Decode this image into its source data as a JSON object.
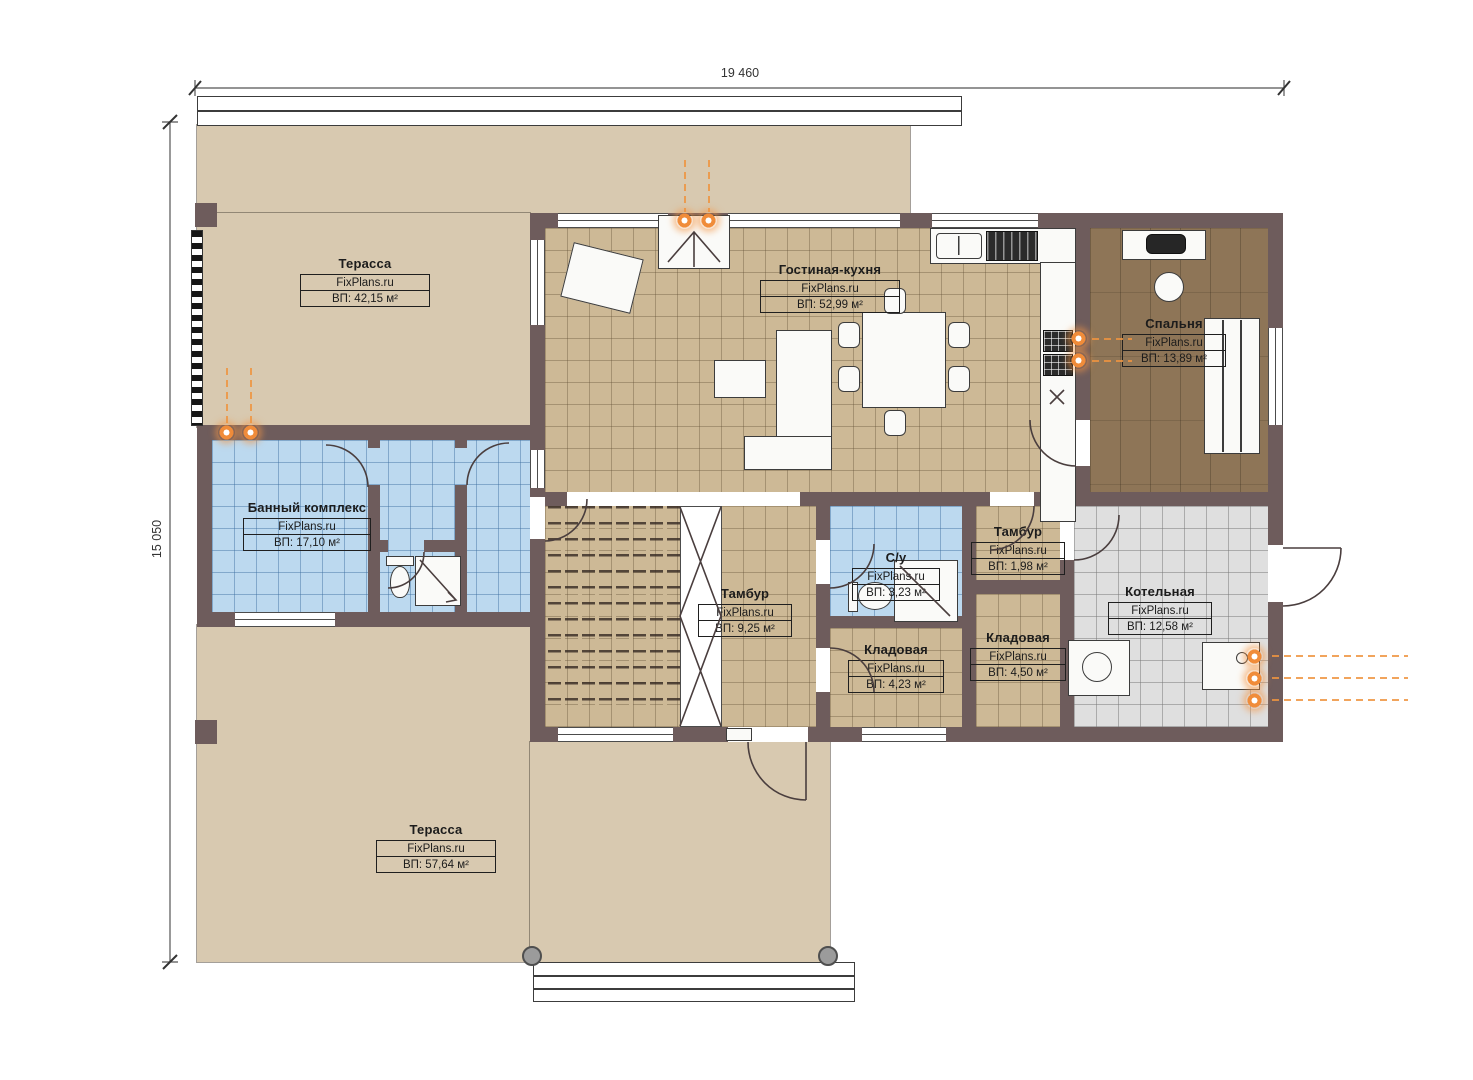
{
  "dimensions": {
    "top": "19 460",
    "left": "15 050"
  },
  "rooms": [
    {
      "id": "terrace-top",
      "name": "Терасса",
      "brand": "FixPlans.ru",
      "area": "ВП: 42,15 м²"
    },
    {
      "id": "living-kitchen",
      "name": "Гостиная-кухня",
      "brand": "FixPlans.ru",
      "area": "ВП: 52,99 м²"
    },
    {
      "id": "bedroom",
      "name": "Спальня",
      "brand": "FixPlans.ru",
      "area": "ВП: 13,89 м²"
    },
    {
      "id": "bath-complex",
      "name": "Банный комплекс",
      "brand": "FixPlans.ru",
      "area": "ВП: 17,10 м²"
    },
    {
      "id": "vestibule-main",
      "name": "Тамбур",
      "brand": "FixPlans.ru",
      "area": "ВП: 9,25 м²"
    },
    {
      "id": "wc",
      "name": "С/у",
      "brand": "FixPlans.ru",
      "area": "ВП: 3,23 м²"
    },
    {
      "id": "vestibule-small",
      "name": "Тамбур",
      "brand": "FixPlans.ru",
      "area": "ВП: 1,98 м²"
    },
    {
      "id": "storage-1",
      "name": "Кладовая",
      "brand": "FixPlans.ru",
      "area": "ВП: 4,23 м²"
    },
    {
      "id": "storage-2",
      "name": "Кладовая",
      "brand": "FixPlans.ru",
      "area": "ВП: 4,50 м²"
    },
    {
      "id": "boiler-room",
      "name": "Котельная",
      "brand": "FixPlans.ru",
      "area": "ВП: 12,58 м²"
    },
    {
      "id": "terrace-bottom",
      "name": "Терасса",
      "brand": "FixPlans.ru",
      "area": "ВП: 57,64 м²"
    }
  ],
  "colors": {
    "wall": "#6e5c5c",
    "terrace": "#d8c9b0",
    "tile_tan": "#cdb996",
    "tile_blue": "#bcd9ef",
    "tile_gray": "#dfdfdf",
    "wood_floor": "#8e7557",
    "accent_orange": "#f08c3a",
    "linework": "#4a3e3e"
  }
}
